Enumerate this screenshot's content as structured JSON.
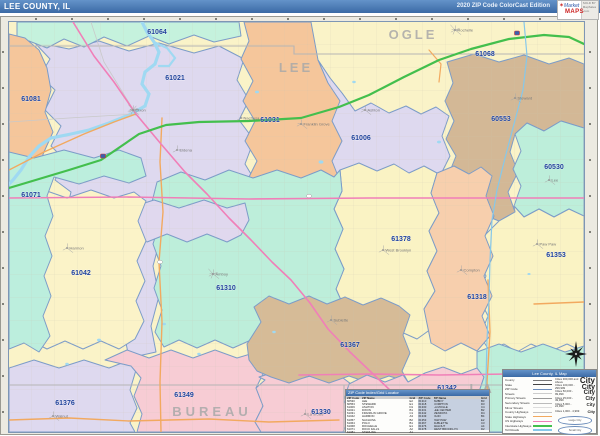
{
  "title_bar": {
    "title": "LEE COUNTY, IL",
    "edition": "2020 ZIP Code ColorCast Edition"
  },
  "logo": {
    "brand_top": "Market",
    "brand_bottom": "MAPS",
    "side_lines": [
      "SOLD BY",
      "MapSales",
      ".com"
    ]
  },
  "map": {
    "base_color": "#faf3c8",
    "border_color": "#7c9cc8",
    "water_color": "#9fd9f2",
    "zip_label_color": "#1c3f99",
    "county_label_color": "#a9a9a9",
    "county_labels": [
      {
        "name": "LEE",
        "x": 287,
        "y": 50,
        "fs": 13,
        "ls": 3
      },
      {
        "name": "OGLE",
        "x": 404,
        "y": 17,
        "fs": 13,
        "ls": 3
      },
      {
        "name": "BUREAU",
        "x": 203,
        "y": 394,
        "fs": 13,
        "ls": 4
      },
      {
        "name": "LA SALLE",
        "x": 512,
        "y": 371,
        "fs": 13,
        "ls": 5
      }
    ],
    "county_lines": [
      "M0,24 L285,24 L285,32 L575,32",
      "M0,363 L575,363",
      "M335,363 L335,410"
    ],
    "regions": [
      {
        "zip": "61021",
        "color": "#ded9ef",
        "lx": 166,
        "ly": 58,
        "points": "25,20 60,27 90,19 120,29 150,21 185,31 210,24 235,37 228,58 240,78 230,98 245,118 236,142 248,162 238,183 215,193 192,186 168,195 150,189 152,214 144,244 150,274 142,304 147,330 120,336 114,306 120,276 112,246 118,216 110,198 82,206 56,194 62,170 46,158 56,138 42,124 52,104 36,88 46,68 31,54 41,37"
      },
      {
        "zip": "61064",
        "color": "#c5f2dd",
        "lx": 148,
        "ly": 12,
        "points": "8,0 230,0 232,14 205,20 185,13 160,22 140,14 118,24 95,15 75,25 55,17 38,26 20,19 8,28"
      },
      {
        "zip": "61081",
        "color": "#f5c69b",
        "lx": 22,
        "ly": 79,
        "points": "0,12 16,16 30,28 38,46 42,68 36,90 44,110 35,130 28,148 18,160 8,170 0,174"
      },
      {
        "zip": "61031",
        "color": "#f5c69b",
        "lx": 261,
        "ly": 100,
        "points": "235,0 302,0 309,38 321,56 333,71 346,89 339,109 346,129 333,149 341,164 322,171 300,164 282,171 262,164 248,169 238,159 248,139 236,119 246,99 234,79 244,59 232,37 240,19"
      },
      {
        "zip": "61006",
        "color": "#ded9ef",
        "lx": 352,
        "ly": 118,
        "points": "309,38 321,56 333,71 346,89 362,81 380,91 397,84 412,92 427,85 440,94 433,114 441,134 431,154 439,174 426,191 433,209 416,221 396,214 376,223 356,215 339,224 323,214 331,194 321,177 331,159 323,139 333,119 323,99 331,79 319,61"
      },
      {
        "zip": "60553",
        "color": "#d3b896",
        "lx": 492,
        "ly": 99,
        "points": "438,40 465,32 490,40 515,33 540,42 560,36 575,42 575,106 552,99 535,109 518,101 506,112 501,130 509,150 499,170 506,190 490,199 470,191 452,199 441,189 449,169 439,154 447,134 437,117 445,99 436,79 444,61"
      },
      {
        "zip": "60530",
        "color": "#bdeeda",
        "lx": 545,
        "ly": 147,
        "points": "506,112 518,101 535,109 552,99 575,106 575,194 560,187 545,195 530,187 515,195 505,184 512,164 504,147 512,129"
      },
      {
        "zip": "61353",
        "color": "#faf3c4",
        "lx": 547,
        "ly": 235,
        "points": "505,184 515,195 530,187 545,195 560,187 575,194 575,330 558,322 540,330 522,322 508,330 495,322 480,328 471,314 479,294 469,274 477,254 467,234 475,214 490,199 506,190"
      },
      {
        "zip": "61378",
        "color": "#faf3c4",
        "lx": 392,
        "ly": 219,
        "points": "331,148 350,141 368,149 385,142 400,151 415,144 428,151 422,171 430,191 420,209 428,229 418,249 426,269 415,287 422,307 408,317 390,309 372,317 355,309 340,317 329,307 336,287 327,267 335,247 326,227 334,207 325,187 333,169"
      },
      {
        "zip": "61318",
        "color": "#f7cfad",
        "lx": 468,
        "ly": 277,
        "points": "428,151 445,144 460,152 472,145 483,154 477,174 485,194 476,214 484,234 475,254 483,274 473,294 481,314 468,329 452,321 436,329 422,321 415,287 426,269 418,249 428,229 420,209 430,191 422,171"
      },
      {
        "zip": "61310",
        "color": "#bdeeda",
        "lx": 217,
        "ly": 268,
        "points": "148,160 172,150 196,158 220,148 244,156 268,148 292,156 312,148 325,155 331,148 333,169 325,187 334,207 326,227 335,247 327,267 336,287 329,307 312,316 295,325 278,318 260,326 242,318 224,326 206,318 188,326 170,318 155,325 146,310 153,288 145,266 152,244 144,222 151,200 143,180"
      },
      {
        "zip": "",
        "color": "#e0d8ee",
        "points": "120,186 145,178 170,186 195,178 218,186 236,181 240,198 232,213 218,220 198,212 178,220 158,212 138,220 122,210 128,196"
      },
      {
        "zip": "61042",
        "color": "#fbf3c8",
        "lx": 72,
        "ly": 253,
        "points": "12,176 35,168 58,176 82,168 105,176 125,170 137,179 129,199 137,219 128,239 136,259 127,279 135,299 126,317 110,327 92,319 74,327 56,319 38,327 22,319 28,299 20,279 27,259 19,239 26,219 18,199"
      },
      {
        "zip": "61071",
        "color": "#bceedd",
        "lx": 22,
        "ly": 175,
        "points": "0,130 25,136 55,128 85,136 110,128 132,136 137,154 120,161 95,154 70,162 45,155 38,174 44,194 36,214 43,234 35,254 42,274 34,294 41,314 30,330 15,321 0,327"
      },
      {
        "zip": "61376",
        "color": "#ded9ef",
        "lx": 56,
        "ly": 383,
        "points": "0,346 25,338 50,346 75,338 100,346 118,339 127,348 121,368 128,386 121,401 126,410 0,410"
      },
      {
        "zip": "61349",
        "color": "#f7ccd4",
        "lx": 175,
        "ly": 375,
        "points": "96,338 118,328 140,336 162,328 184,336 206,328 228,336 248,330 256,348 247,366 254,384 246,400 252,410 128,410 133,392 125,374 132,356 122,344"
      },
      {
        "zip": "61330",
        "color": "#f7ccd4",
        "lx": 312,
        "ly": 392,
        "points": "250,355 272,348 294,356 316,350 334,356 342,362 335,378 342,394 334,410 252,410 246,400 254,384 247,366 256,358"
      },
      {
        "zip": "61367",
        "color": "#d6bb97",
        "lx": 341,
        "ly": 325,
        "points": "238,322 252,300 245,285 260,274 280,282 300,274 318,282 336,275 354,283 372,276 390,284 401,293 394,313 401,331 393,349 399,360 380,354 360,361 340,354 320,361 300,354 280,361 262,355 248,349 240,338"
      },
      {
        "zip": "61342",
        "color": "#f7ccd4",
        "lx": 438,
        "ly": 368,
        "points": "340,362 358,353 376,360 394,353 399,360 416,351 434,345 452,352 468,346 475,355 469,373 476,391 468,405 472,410 336,410 342,394 335,378"
      },
      {
        "zip": "",
        "color": "#bdeeda",
        "points": "468,330 490,322 512,330 534,322 556,330 575,324 575,410 472,410 468,405 476,391 469,373 475,355 468,346"
      }
    ],
    "floating_labels": [
      {
        "zip": "61068",
        "x": 476,
        "y": 34
      }
    ],
    "roads": [
      {
        "name": "county-road",
        "color": "#c9c9c9",
        "w": 0.8,
        "points": "0,100 60,96 127,92"
      },
      {
        "name": "county-road",
        "color": "#c9c9c9",
        "w": 0.8,
        "points": "127,92 95,40 82,0"
      },
      {
        "name": "state-highway",
        "color": "#f2a95f",
        "w": 1.4,
        "points": "153,96 151,140 154,190 150,240 153,300 151,360 152,410"
      },
      {
        "name": "state-highway",
        "color": "#f2a95f",
        "w": 1.4,
        "points": "0,148 35,130 75,112 105,100 127,92"
      },
      {
        "name": "state-highway",
        "color": "#f2a95f",
        "w": 1.4,
        "points": "479,258 481,310 478,360 480,410"
      },
      {
        "name": "state-highway",
        "color": "#f2a95f",
        "w": 1.4,
        "points": "0,398 60,396 120,399 200,397 260,400 330,398"
      },
      {
        "name": "state-highway",
        "color": "#f2a95f",
        "w": 1.4,
        "points": "525,282 575,280"
      },
      {
        "name": "state-highway",
        "color": "#f2a95f",
        "w": 1.2,
        "points": "420,28 432,42 430,60"
      },
      {
        "name": "us-highway",
        "color": "#f07fb8",
        "w": 1.6,
        "points": "64,0 85,34 105,60 127,92 152,122 176,150 198,172 220,196 242,218 263,240 282,258 301,281 319,307 341,330 362,350 384,371 400,388 412,410"
      },
      {
        "name": "us-highway",
        "color": "#f07fb8",
        "w": 1.6,
        "points": "0,176 120,175 240,177 360,176 480,176 575,176"
      },
      {
        "name": "us-highway",
        "color": "#f07fb8",
        "w": 1.6,
        "points": "290,353 360,352 430,353 500,352 575,351"
      },
      {
        "name": "interstate-highway",
        "color": "#43bf4d",
        "w": 2.2,
        "points": "0,166 30,157 60,148 92,138 130,112 157,103 190,100 240,99 292,96 330,85 360,73 395,55 430,38 462,27 500,17 535,13 560,15 575,22"
      },
      {
        "name": "creek",
        "color": "#86c8ea",
        "w": 1.2,
        "points": "515,0 518,34 514,68 505,102 496,136 488,168 483,198 481,238 480,278 478,318 477,358 476,410"
      }
    ],
    "rivers": [
      {
        "w": 3.2,
        "points": "133,0 138,10 145,20 150,30 146,42 136,50 133,62 140,72 136,84 120,93 100,101 80,108 62,112 42,116 30,124 20,135 12,148 4,158 0,162"
      },
      {
        "w": 2.2,
        "points": "145,20 158,26 166,36 160,44 150,44"
      }
    ],
    "lakes": [
      [
        90,
        318,
        2,
        1.4
      ],
      [
        248,
        70,
        2,
        1.4
      ],
      [
        312,
        140,
        2.4,
        1.6
      ],
      [
        190,
        332,
        1.8,
        1.2
      ],
      [
        520,
        252,
        1.6,
        1
      ],
      [
        155,
        302,
        2,
        1.3
      ],
      [
        430,
        120,
        2,
        1.4
      ],
      [
        58,
        342,
        1.8,
        1.2
      ],
      [
        345,
        60,
        1.8,
        1.2
      ],
      [
        265,
        310,
        1.8,
        1.2
      ]
    ],
    "towns": [
      {
        "name": "Dixon",
        "x": 124,
        "y": 88,
        "c": 14
      },
      {
        "name": "Rochelle",
        "x": 446,
        "y": 8,
        "c": 9
      },
      {
        "name": "Amboy",
        "x": 204,
        "y": 252,
        "c": 8
      },
      {
        "name": "Mendota",
        "x": 402,
        "y": 386,
        "c": 8
      },
      {
        "name": "Ashton",
        "x": 356,
        "y": 88,
        "c": 5
      },
      {
        "name": "Franklin Grove",
        "x": 292,
        "y": 102,
        "c": 5
      },
      {
        "name": "Steward",
        "x": 506,
        "y": 76,
        "c": 4
      },
      {
        "name": "Lee",
        "x": 540,
        "y": 158,
        "c": 4
      },
      {
        "name": "Paw Paw",
        "x": 528,
        "y": 222,
        "c": 4
      },
      {
        "name": "West Brooklyn",
        "x": 374,
        "y": 228,
        "c": 4
      },
      {
        "name": "Compton",
        "x": 452,
        "y": 248,
        "c": 4
      },
      {
        "name": "Sublette",
        "x": 322,
        "y": 298,
        "c": 4
      },
      {
        "name": "Harmon",
        "x": 58,
        "y": 226,
        "c": 4
      },
      {
        "name": "Eldena",
        "x": 168,
        "y": 128,
        "c": 3
      },
      {
        "name": "Nachusa",
        "x": 232,
        "y": 96,
        "c": 3
      },
      {
        "name": "Walnut",
        "x": 44,
        "y": 394,
        "c": 4
      },
      {
        "name": "La Moille",
        "x": 296,
        "y": 392,
        "c": 4
      }
    ],
    "markers": [
      {
        "kind": "interstate",
        "x": 508,
        "y": 11
      },
      {
        "kind": "interstate",
        "x": 94,
        "y": 134
      },
      {
        "kind": "us",
        "x": 300,
        "y": 174
      },
      {
        "kind": "us",
        "x": 151,
        "y": 240
      }
    ]
  },
  "legend": {
    "title": "Lee County, IL Map",
    "line_items": [
      {
        "label": "County",
        "color": "#777777",
        "w": 1.6
      },
      {
        "label": "State",
        "color": "#444444",
        "w": 1.2
      },
      {
        "label": "ZIP Code",
        "color": "#6b8cba",
        "w": 1.6
      },
      {
        "label": "Streets",
        "color": "#cccccc",
        "w": 1
      },
      {
        "label": "Primary Streets",
        "color": "#999999",
        "w": 1.4
      },
      {
        "label": "Secondary Streets",
        "color": "#bbbbbb",
        "w": 1.2
      },
      {
        "label": "Minor Streets",
        "color": "#dddddd",
        "w": 1
      },
      {
        "label": "County Highways",
        "color": "#c2c2c2",
        "w": 1.4
      },
      {
        "label": "State Highways",
        "color": "#f2a95f",
        "w": 1.8
      },
      {
        "label": "US Highways",
        "color": "#f07fb8",
        "w": 1.8
      },
      {
        "label": "Interstate Highways",
        "color": "#43bf4d",
        "w": 2
      },
      {
        "label": "Toll Roads",
        "color": "#86c8ea",
        "w": 2
      }
    ],
    "city_sample": "City",
    "city_items": [
      {
        "label": "Cities 300,000 and Above",
        "px": 8
      },
      {
        "label": "Cities 100,000 - 299,999",
        "px": 7
      },
      {
        "label": "Cities 50,000 - 99,999",
        "px": 6
      },
      {
        "label": "Cities 25,000 - 49,999",
        "px": 5
      },
      {
        "label": "Cities 5,000 - 24,999",
        "px": 4.5
      },
      {
        "label": "Cities 1,000 - 4,999",
        "px": 4
      }
    ],
    "area_items": [
      {
        "label": "Large City"
      },
      {
        "label": "Small City"
      }
    ]
  },
  "zip_index": {
    "title": "ZIP Code Index/Grid Locator",
    "headers": [
      "ZIP Code",
      "ZIP Name",
      "Grid"
    ],
    "left": [
      [
        "60530",
        "LEE",
        "E2"
      ],
      [
        "60553",
        "STEWARD",
        "E1"
      ],
      [
        "61006",
        "ASHTON",
        "D1"
      ],
      [
        "61021",
        "DIXON",
        "B1"
      ],
      [
        "61031",
        "FRANKLIN GROVE",
        "C1"
      ],
      [
        "61042",
        "HARMON",
        "A3"
      ],
      [
        "61057",
        "NACHUSA",
        "B2"
      ],
      [
        "61064",
        "POLO",
        "B1"
      ],
      [
        "61068",
        "ROCHELLE",
        "E1"
      ],
      [
        "61071",
        "ROCK FALLS",
        "A2"
      ],
      [
        "61081",
        "STERLING",
        "A1"
      ]
    ],
    "right": [
      [
        "61310",
        "AMBOY",
        "B3"
      ],
      [
        "61318",
        "COMPTON",
        "D3"
      ],
      [
        "61330",
        "LA MOILLE",
        "C4"
      ],
      [
        "61331",
        "LEE CENTER",
        "B2"
      ],
      [
        "61342",
        "MENDOTA",
        "D4"
      ],
      [
        "61349",
        "OHIO",
        "B4"
      ],
      [
        "61353",
        "PAW PAW",
        "E2"
      ],
      [
        "61367",
        "SUBLETTE",
        "C3"
      ],
      [
        "61376",
        "WALNUT",
        "A4"
      ],
      [
        "61378",
        "WEST BROOKLYN",
        "D2"
      ]
    ]
  }
}
